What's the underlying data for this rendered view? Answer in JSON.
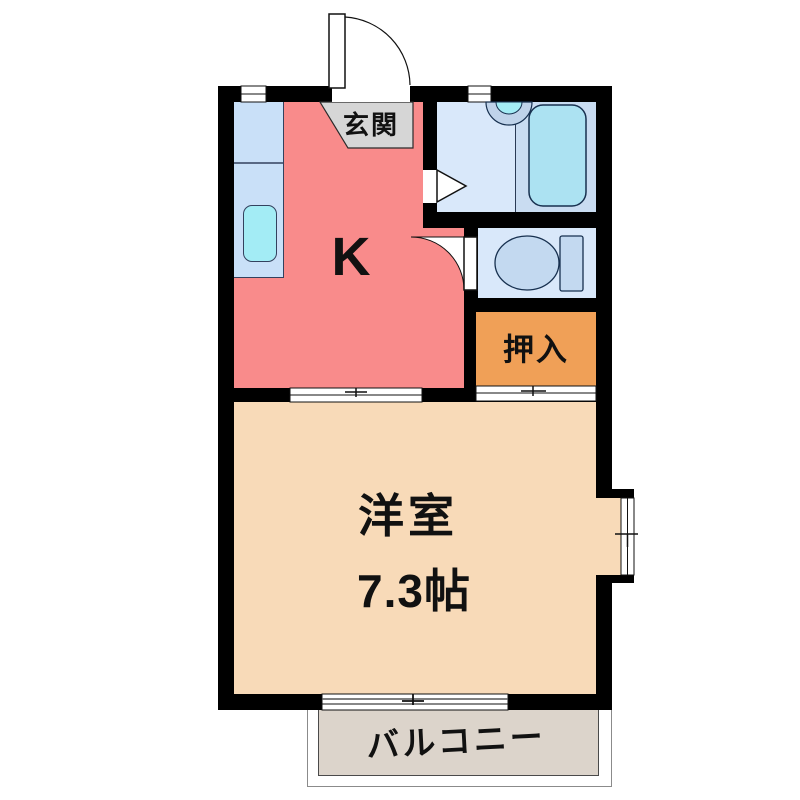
{
  "plan": {
    "type": "floor-plan",
    "labels": {
      "entrance": "玄関",
      "kitchen": "K",
      "closet": "押入",
      "main_room_name": "洋室",
      "main_room_size": "7.3帖",
      "balcony": "バルコニー"
    },
    "colors": {
      "wall": "#000000",
      "kitchen": "#F98B8B",
      "entrance_floor": "#D6D6D6",
      "wet_room": "#D9E8FA",
      "wet_room_dark": "#C9DCF1",
      "fixture": "#C3D9F0",
      "tub": "#ACE2F2",
      "sink": "#A3ECF5",
      "counter": "#C9E0F8",
      "closet": "#F0A057",
      "main_room": "#F8DAB8",
      "balcony": "#DCD4CB"
    }
  }
}
